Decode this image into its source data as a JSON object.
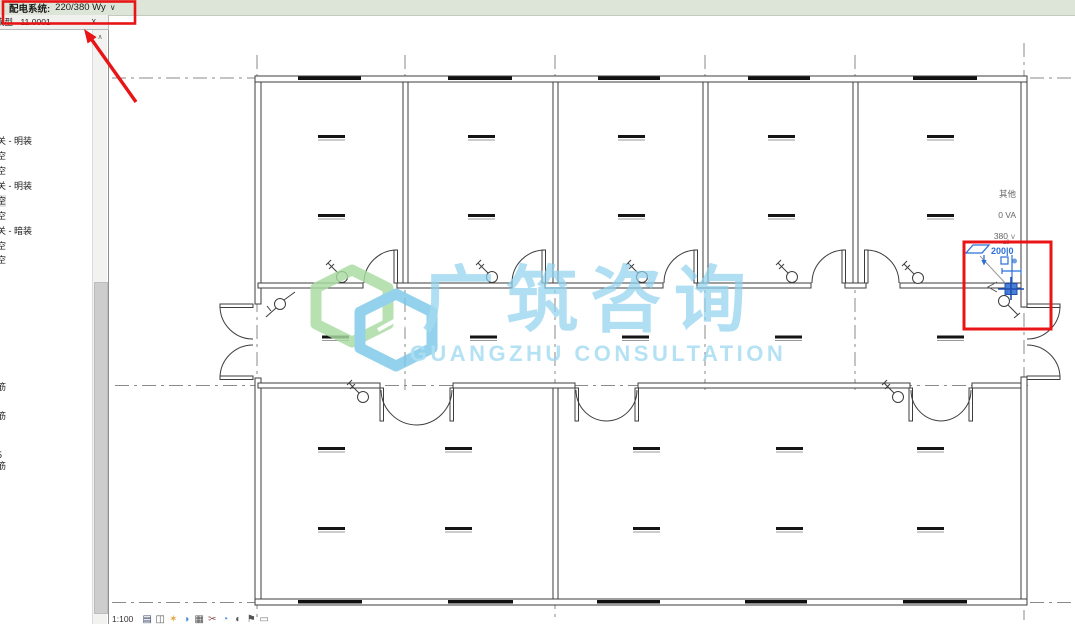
{
  "options_bar": {
    "label": "配电系统:",
    "value": "220/380 Wy",
    "chevron": "∨"
  },
  "type_selector": {
    "value": "模型 - 11.0001",
    "close": "x",
    "scroll_up": "∧"
  },
  "sidebar": {
    "items": [
      {
        "label": "关 - 明装"
      },
      {
        "label": "空"
      },
      {
        "label": "空"
      },
      {
        "label": "关 - 明装"
      },
      {
        "label": "空"
      },
      {
        "label": "空"
      },
      {
        "label": "关 - 暗装"
      },
      {
        "label": "空"
      },
      {
        "label": "空"
      }
    ],
    "fragments": [
      {
        "label": "筋"
      },
      {
        "label": "筋"
      },
      {
        "label": "5"
      },
      {
        "label": "筋"
      }
    ]
  },
  "watermark": {
    "cn": "广筑咨询",
    "en": "GUANGZHU CONSULTATION",
    "logo_green": "#a9dba2",
    "logo_blue": "#7cc8e8",
    "text_blue": "#8fd2ee"
  },
  "selection_tag": {
    "other": "其他",
    "va": "0 VA",
    "volt": "380",
    "volt_unit": "V",
    "dim": "200|0",
    "dim_note": "±3"
  },
  "view_bar": {
    "scale": "1:100",
    "icons": [
      {
        "name": "detail-level-icon",
        "glyph": "▤",
        "color": "#3a4a66"
      },
      {
        "name": "visual-style-icon",
        "glyph": "◫",
        "color": "#555555"
      },
      {
        "name": "sun-path-icon",
        "glyph": "✶",
        "color": "#e8a33d"
      },
      {
        "name": "shadows-icon",
        "glyph": "◑",
        "color": "#4a90d9"
      },
      {
        "name": "crop-view-icon",
        "glyph": "▦",
        "color": "#555555"
      },
      {
        "name": "crop-region-icon",
        "glyph": "✂",
        "color": "#8a4a4a"
      },
      {
        "name": "temporary-hide-icon",
        "glyph": "◔",
        "color": "#4a90d9"
      },
      {
        "name": "reveal-hidden-icon",
        "glyph": "◐",
        "color": "#555555"
      },
      {
        "name": "constraints-icon",
        "glyph": "⚑",
        "color": "#555555"
      },
      {
        "name": "worksets-icon",
        "glyph": "▭",
        "color": "#777777"
      }
    ]
  },
  "colors": {
    "annotation_red": "#e81416",
    "selection_blue": "#2b6fd6",
    "options_bar_bg": "#dde5d8",
    "grid_gray": "#8a8a8a"
  }
}
